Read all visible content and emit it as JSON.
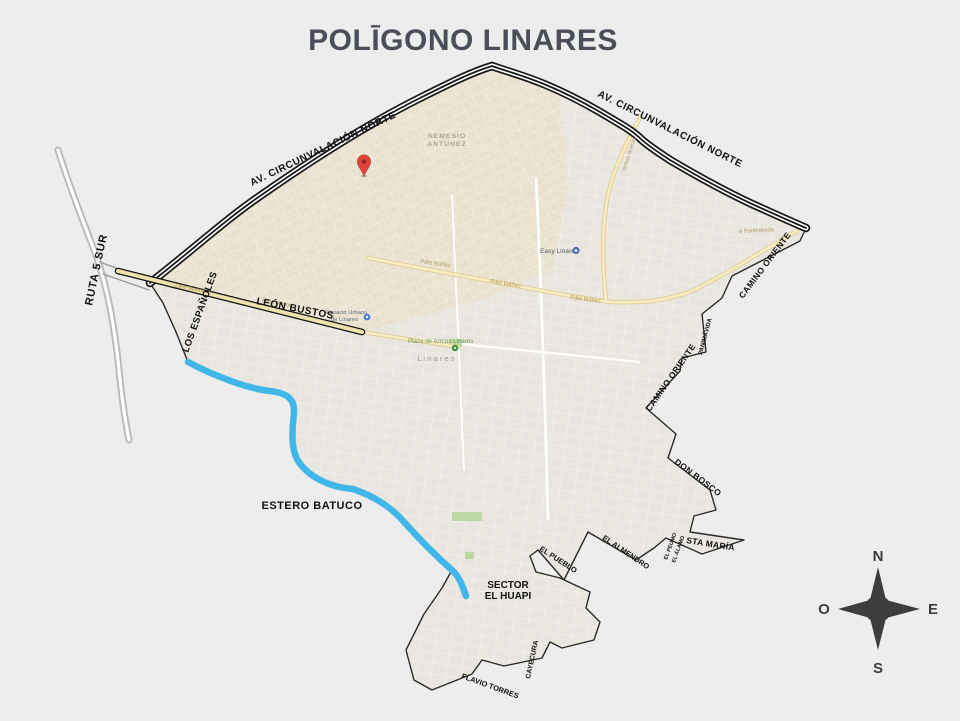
{
  "title": "POLĪGONO LINARES",
  "colors": {
    "background": "#ededed",
    "title": "#4a4e59",
    "polygon_fill": "#e9e6df",
    "boundary": "#2b2a28",
    "river": "#41b7e9",
    "road_yellow": "#f7ecc0",
    "road_casing": "#ddca92",
    "ruta5_gray": "#b9b9b9",
    "pin_red": "#e0443a",
    "compass": "#3d3d3d",
    "park_green": "#bcd9a4"
  },
  "labels": {
    "circunvalacion": "AV. CIRCUNVALACIÓN NORTE",
    "ruta5": "RUTA 5 SUR",
    "leon_bustos": "LEÓN BUSTOS",
    "los_espanoles": "LOS ESPAÑOLES",
    "camino_oriente": "CAMINO ORIENTE",
    "panimavida_edge": "PANIMÁVIDA",
    "don_bosco": "DON BOSCO",
    "el_pueblo": "EL PUEBLO",
    "el_almendro": "EL ALMENDRO",
    "edge_small_1": "EL PEUMO",
    "edge_small_2": "EL ÁLAMO",
    "sta_maria": "STA MARÍA",
    "estero_batuco": "ESTERO BATUCO",
    "sector_1": "SECTOR",
    "sector_2": "EL HUAPI",
    "flavio_torres": "FLAVIO TORRES",
    "cayecura": "CAYECURA"
  },
  "streets": {
    "nemesio_1": "NEMESIO",
    "nemesio_2": "ANTUNEZ",
    "a_panimavida": "a Panimávida",
    "pdte_ibanez": "Pdte Ibáñez",
    "leon_bustos_road": "León Bustos",
    "yerbas_buenas": "Yerbas Buenas"
  },
  "pois": {
    "easy": "Easy Linares",
    "espacio_1": "Espacio Urbano",
    "espacio_2": "de Linares",
    "plaza": "Plaza de Armas Linares",
    "linares": "L i n a r e s"
  },
  "compass": {
    "n": "N",
    "s": "S",
    "e": "E",
    "o": "O"
  }
}
